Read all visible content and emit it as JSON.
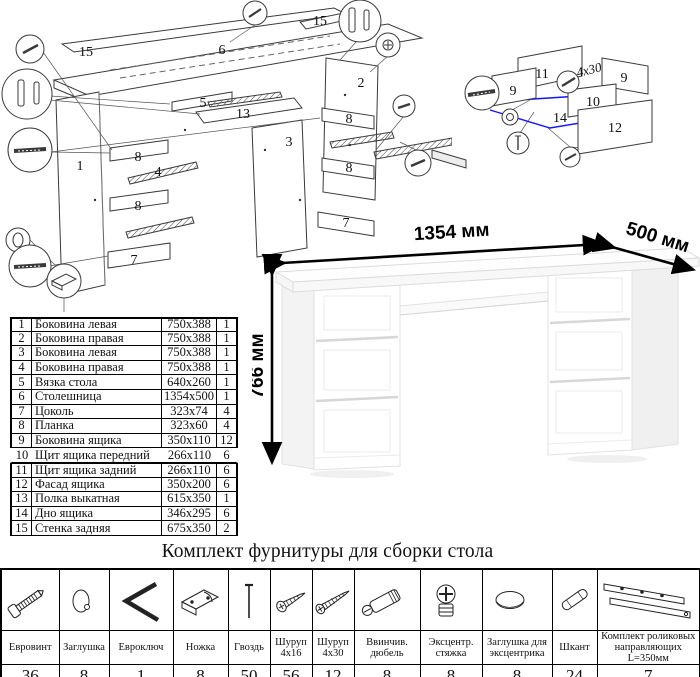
{
  "colors": {
    "accent_blue": "#1414ff",
    "line_art": "#3a3a3a"
  },
  "exploded_desk": {
    "labels": [
      "15",
      "6",
      "15",
      "5",
      "13",
      "3",
      "2",
      "1",
      "8",
      "4",
      "8",
      "7",
      "8",
      "8",
      "7"
    ]
  },
  "exploded_drawer": {
    "labels": [
      "11",
      "9",
      "9",
      "10",
      "14",
      "12"
    ],
    "annotation": "4x30"
  },
  "parts_table": {
    "rows": [
      {
        "num": "1",
        "name": "Боковина левая",
        "size": "750x388",
        "qty": "1"
      },
      {
        "num": "2",
        "name": "Боковина правая",
        "size": "750x388",
        "qty": "1"
      },
      {
        "num": "3",
        "name": "Боковина левая",
        "size": "750x388",
        "qty": "1"
      },
      {
        "num": "4",
        "name": "Боковина правая",
        "size": "750x388",
        "qty": "1"
      },
      {
        "num": "5",
        "name": "Вязка стола",
        "size": "640x260",
        "qty": "1"
      },
      {
        "num": "6",
        "name": "Столешница",
        "size": "1354x500",
        "qty": "1"
      },
      {
        "num": "7",
        "name": "Цоколь",
        "size": "323x74",
        "qty": "4"
      },
      {
        "num": "8",
        "name": "Планка",
        "size": "323x60",
        "qty": "4"
      },
      {
        "num": "9",
        "name": "Боковина ящика",
        "size": "350x110",
        "qty": "12"
      },
      {
        "num": "10",
        "name": "Щит ящика передний",
        "size": "266x110",
        "qty": "6"
      },
      {
        "num": "11",
        "name": "Щит ящика задний",
        "size": "266x110",
        "qty": "6"
      },
      {
        "num": "12",
        "name": "Фасад ящика",
        "size": "350x200",
        "qty": "6"
      },
      {
        "num": "13",
        "name": "Полка выкатная",
        "size": "615x350",
        "qty": "1"
      },
      {
        "num": "14",
        "name": "Дно ящика",
        "size": "346x295",
        "qty": "6"
      },
      {
        "num": "15",
        "name": "Стенка задняя",
        "size": "675x350",
        "qty": "2"
      }
    ]
  },
  "desk_view": {
    "width_label": "1354 мм",
    "depth_label": "500 мм",
    "height_label": "766 мм"
  },
  "hardware": {
    "title": "Комплект фурнитуры для сборки стола",
    "items": [
      {
        "name": "Евровинт",
        "qty": "36"
      },
      {
        "name": "Заглушка",
        "qty": "8"
      },
      {
        "name": "Евроключ",
        "qty": "1"
      },
      {
        "name": "Ножка",
        "qty": "8"
      },
      {
        "name": "Гвоздь",
        "qty": "50"
      },
      {
        "name": "Шуруп 4x16",
        "qty": "56"
      },
      {
        "name": "Шуруп 4x30",
        "qty": "12"
      },
      {
        "name": "Ввинчив. дюбель",
        "qty": "8"
      },
      {
        "name": "Эксцентр. стяжка",
        "qty": "8"
      },
      {
        "name": "Заглушка для эксцентрика",
        "qty": "8"
      },
      {
        "name": "Шкант",
        "qty": "24"
      },
      {
        "name": "Комплект роликовых направляющих L=350мм",
        "qty": "7"
      }
    ]
  }
}
